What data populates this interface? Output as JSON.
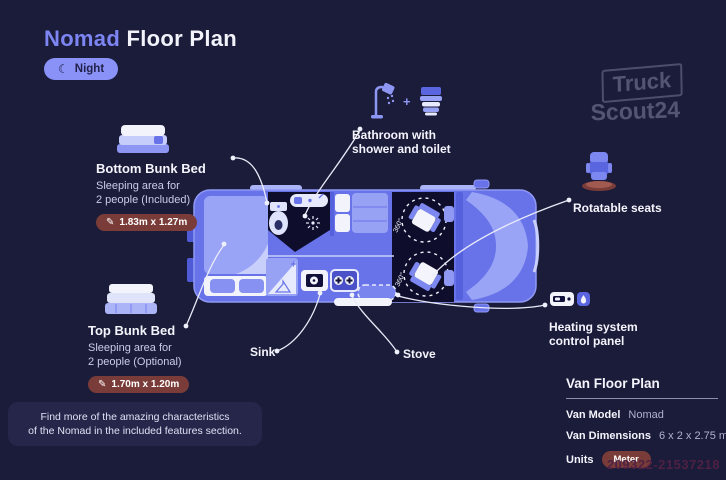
{
  "header": {
    "title_accent": "Nomad",
    "title_rest": " Floor Plan",
    "mode_toggle": {
      "label": "Night"
    }
  },
  "icons": {
    "moon": "☾",
    "pencil": "✎",
    "plus": "+"
  },
  "watermark": {
    "line1": "Truck",
    "line2": "Scout24"
  },
  "callouts": {
    "bottom_bunk": {
      "title": "Bottom Bunk Bed",
      "desc_line1": "Sleeping area for",
      "desc_line2": "2 people (Included)",
      "dimensions": "1.83m x 1.27m"
    },
    "top_bunk": {
      "title": "Top Bunk Bed",
      "desc_line1": "Sleeping area for",
      "desc_line2": "2 people (Optional)",
      "dimensions": "1.70m x 1.20m"
    },
    "bathroom": {
      "line1": "Bathroom with",
      "line2": "shower and toilet"
    },
    "rotatable_seats": {
      "label": "Rotatable seats"
    },
    "heating": {
      "line1": "Heating system",
      "line2": "control panel"
    },
    "sink": {
      "label": "Sink"
    },
    "stove": {
      "label": "Stove"
    }
  },
  "floorplan": {
    "rotation_label": "360°"
  },
  "info_panel": {
    "title": "Van Floor Plan",
    "rows": [
      {
        "label": "Van Model",
        "value": "Nomad"
      },
      {
        "label": "Van Dimensions",
        "value": "6 x 2 x 2.75 m"
      },
      {
        "label": "Units",
        "value": "Meter"
      }
    ]
  },
  "footer_note": {
    "line1": "Find more of the amazing characteristics",
    "line2": "of the Nomad in the included features section."
  },
  "listing_id": "209322-21537218",
  "colors": {
    "background": "#1b1b3a",
    "accent_purple": "#7d85f3",
    "van_body": "#6873e9",
    "van_light": "#9aa4f6",
    "interior_dark": "#0e0e2c",
    "badge_maroon": "#7a3c38",
    "night_pill": "#8a92f8",
    "note_bg": "#26264a"
  }
}
